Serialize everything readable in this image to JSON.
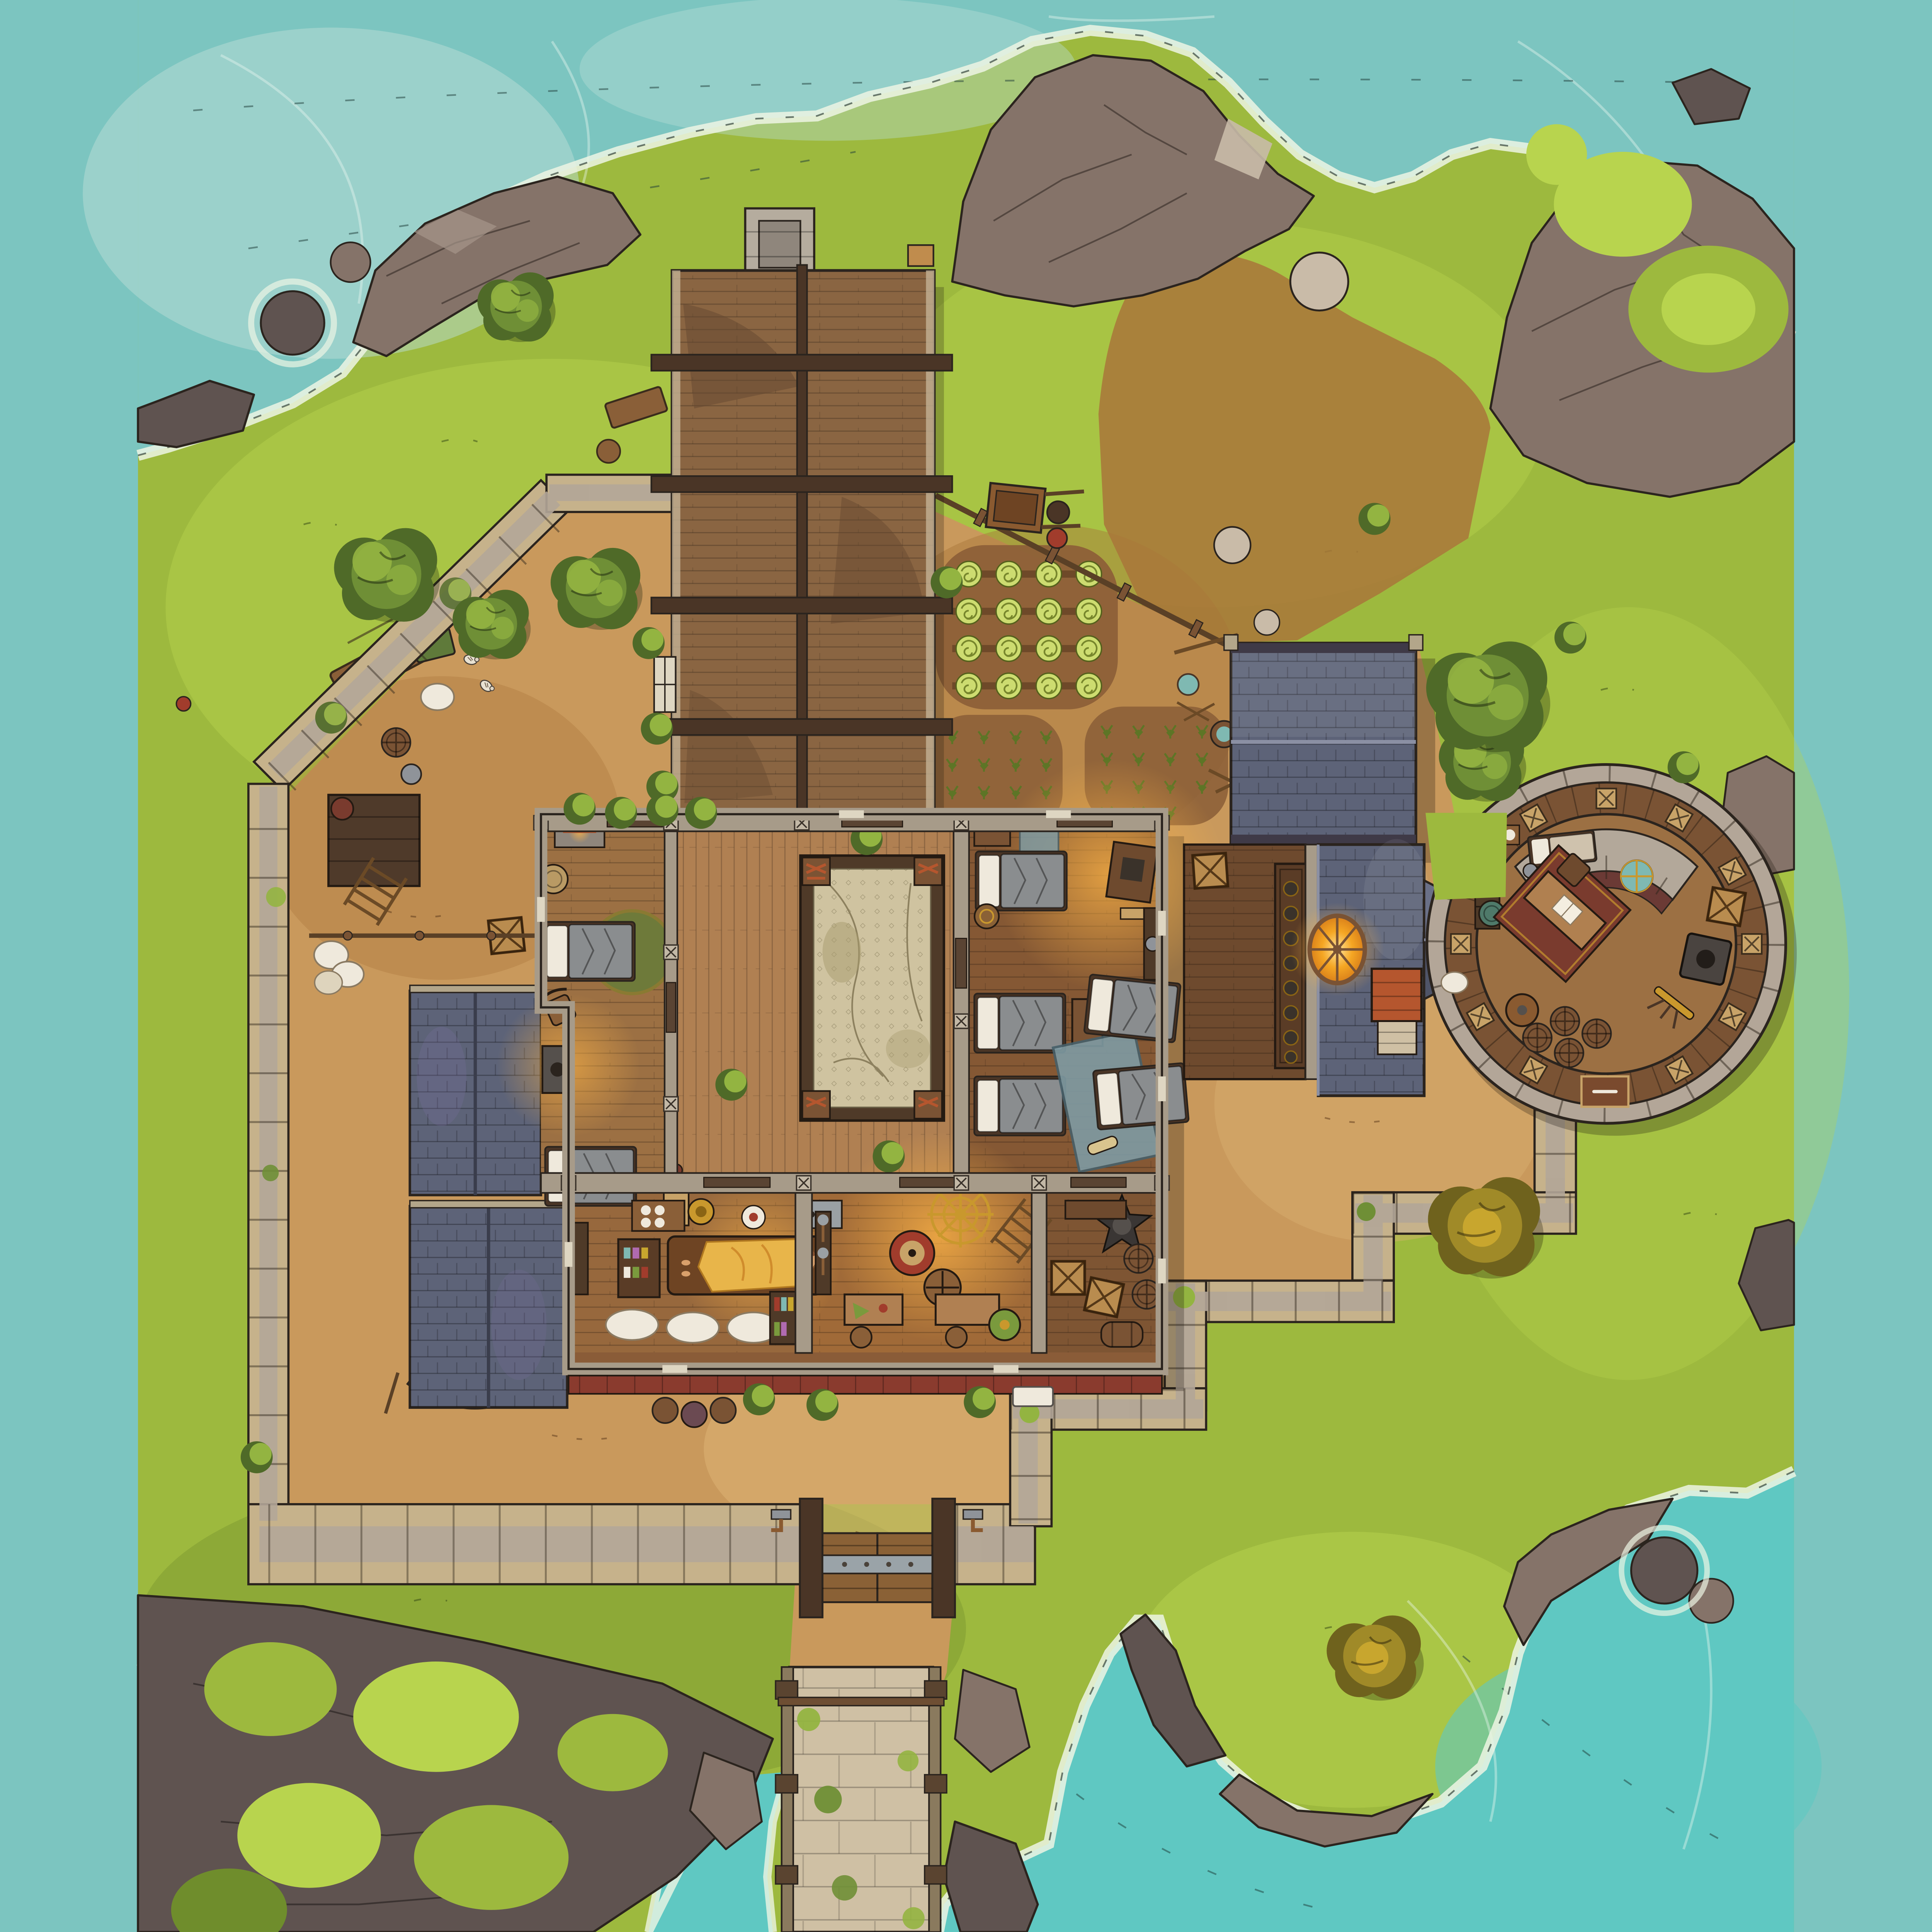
{
  "map": {
    "type": "fantasy-battle-map",
    "view": "top-down",
    "setting": "coastal fortified compound on a rocky island shore",
    "grid_visible": false,
    "text_labels": []
  },
  "palette": {
    "ink": "#2b241e",
    "water": "#7cc5c0",
    "waterBright": "#5fc8c2",
    "waterPale": "#b9ded6",
    "foam": "#edf5e4",
    "grass": "#9db93e",
    "grassLight": "#b8d44e",
    "grassDark": "#6f8d2c",
    "canopy": "#6f8f36",
    "canopyLight": "#93b441",
    "canopyDark": "#4f6a28",
    "autumn": "#a08a28",
    "autumnLight": "#c8a62e",
    "autumnDark": "#6f621d",
    "rock": "#857369",
    "rockLight": "#a5958a",
    "rockDark": "#5f5350",
    "rockPale": "#c9bba8",
    "dirt": "#c9995c",
    "dirtLight": "#dcb274",
    "dirtDark": "#a9763a",
    "soil": "#8d6038",
    "stoneWall": "#c6b28b",
    "stoneWalk": "#b3a698",
    "stonePale": "#cfc0a4",
    "chimney": "#b5ac9e",
    "woodRoof": "#8a6542",
    "woodRoofDark": "#64482f",
    "woodBeam": "#4a3526",
    "deck": "#b08052",
    "floor": "#9c7043",
    "floorDark": "#855834",
    "floorDeep": "#6e4a2e",
    "slate": "#5d6378",
    "slateLight": "#7d8298",
    "slateDark": "#434657",
    "tile": "#cfc3a0",
    "tileCrack": "#8d815f",
    "awning": "#8a3b2e",
    "porch": "#b5562e",
    "blanket": "#8a8d8f",
    "pillow": "#efe9dc",
    "rugTeal": "#7f9ba3",
    "rugRed": "#7a3b2e",
    "rugGreen": "#6e7a3a",
    "glow": "#f5a623",
    "gold": "#c9982d",
    "barrel": "#7a5334",
    "crate": "#b98c4f",
    "boat": "#6b4a3d"
  },
  "features": [
    {
      "id": "sea",
      "label": "surrounding sea with foam lines and scattered reef rocks"
    },
    {
      "id": "coastal-rocks",
      "label": "grey rocky cliffs along every shore"
    },
    {
      "id": "grass-island",
      "label": "yellow-green grassland island"
    },
    {
      "id": "perimeter-wall",
      "label": "tan stone curtain wall with inner walkway"
    },
    {
      "id": "south-gate",
      "label": "double wooden gate with steel bands and wall sconces"
    },
    {
      "id": "causeway",
      "label": "stone causeway running south over the water"
    },
    {
      "id": "longhouse-barn",
      "label": "long plank-roofed barn with stone chimney and cross beams"
    },
    {
      "id": "main-hall",
      "label": "main hall: west dorm, central courtyard with tiled pit, east dorm, infirmary, training room, storage"
    },
    {
      "id": "courtyard-pit",
      "label": "sunken cracked-tile courtyard framed in dark wood with corner planters"
    },
    {
      "id": "infirmary",
      "label": "infirmary with patient table, medicine cabinet and bedrolls"
    },
    {
      "id": "training-room",
      "label": "training room with gold compass inlay, targets and weapon racks"
    },
    {
      "id": "chapel",
      "label": "slate-roofed chapel with altar table, glowing rose window, north annex and porch"
    },
    {
      "id": "roof-bridge",
      "label": "slate roof bridge linking chapel to tower"
    },
    {
      "id": "round-tower",
      "label": "round watchtower with wooden walkway ring, study desk, globe, stove and barrels"
    },
    {
      "id": "stables",
      "label": "two blue-slate lean-to stable roofs on the west wall"
    },
    {
      "id": "rowboat",
      "label": "beached wooden rowboat"
    },
    {
      "id": "gardens",
      "label": "cabbage patch and two sprout plots with tools and water bucket"
    },
    {
      "id": "pole-fence",
      "label": "diagonal rope-and-post fence on the northeast side"
    },
    {
      "id": "livestock-yard",
      "label": "chicken yard with trough, feed box, sacks and platform"
    },
    {
      "id": "wheelbarrow",
      "label": "wheelbarrow by the garden"
    },
    {
      "id": "autumn-trees",
      "label": "golden autumn trees southeast and on the south headland"
    },
    {
      "id": "green-trees",
      "label": "dark green canopies inside the north wall and beside the tower"
    }
  ]
}
